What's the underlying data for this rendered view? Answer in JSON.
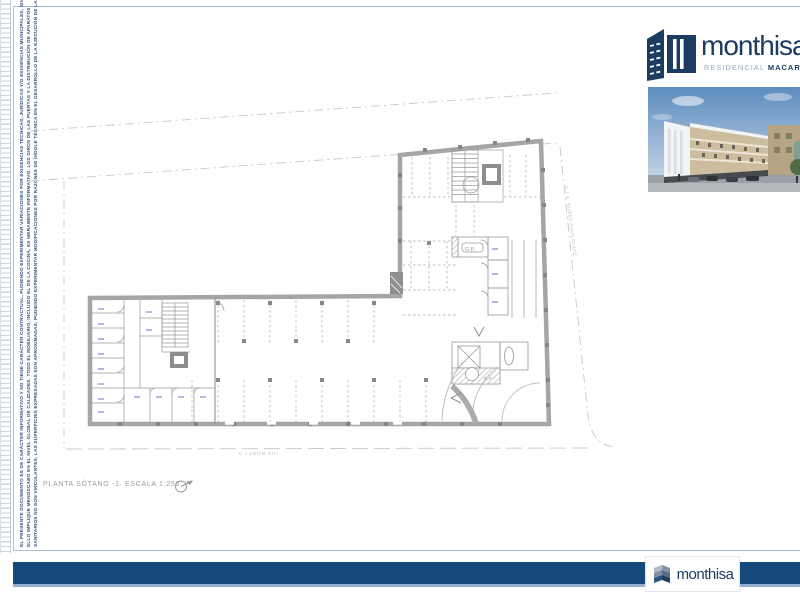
{
  "page": {
    "plan_title": "PLANTA SÓTANO -1. ESCALA 1:250",
    "street_bottom": "C /  LEON XIII",
    "street_right": "C /  A. NUÑEZ CHOCOLATE"
  },
  "branding": {
    "logo_text": "monthisa",
    "residential_label": "RESIDENCIAL",
    "project_label": "MACARENA",
    "footer_logo_text": "monthisa",
    "navy": "#1d3c61",
    "footer_bar_color": "#16497c",
    "footer_underline_color": "#8fb0d1"
  },
  "plan_labels": {
    "gp_room": "G.P.",
    "gp_core": "G.P."
  },
  "disclaimer": {
    "line1": "EL PRESENTE DOCUMENTO ES DE CARÁCTER INFORMATIVO Y NO TIENE CARÁCTER CONTRACTUAL, PUDIENDO EXPERIMENTAR VARIACIONES POR EXIGENCIAS TÉCNICAS, JURÍDICAS Y/O EXIGENCIAS MUNICIPALES, SIN QUE",
    "line2": "ELLO IMPLIQUE MENOSCABO EN EL NIVEL GLOBAL DE CALIDADES. TODO EL MOBILIARIO, INCLUIDO EL DE LA COCINA, ES MERAMENTE INFORMATIVO. LOS GIROS DE LAS PUERTAS Y LA DISTRIBUCIÓN DE APARATOS",
    "line3": "SANITARIOS NO SON VINCULANTES, LAS SUPERFICIES EXPRESADAS SON APROXIMADAS, PUDIENDO EXPERIMENTAR MODIFICACIONES POR RAZONES DE ÍNDOLE TÉCNICA EN EL DESARROLLO DE LA EJECUCIÓN DE LAS OBRAS."
  }
}
